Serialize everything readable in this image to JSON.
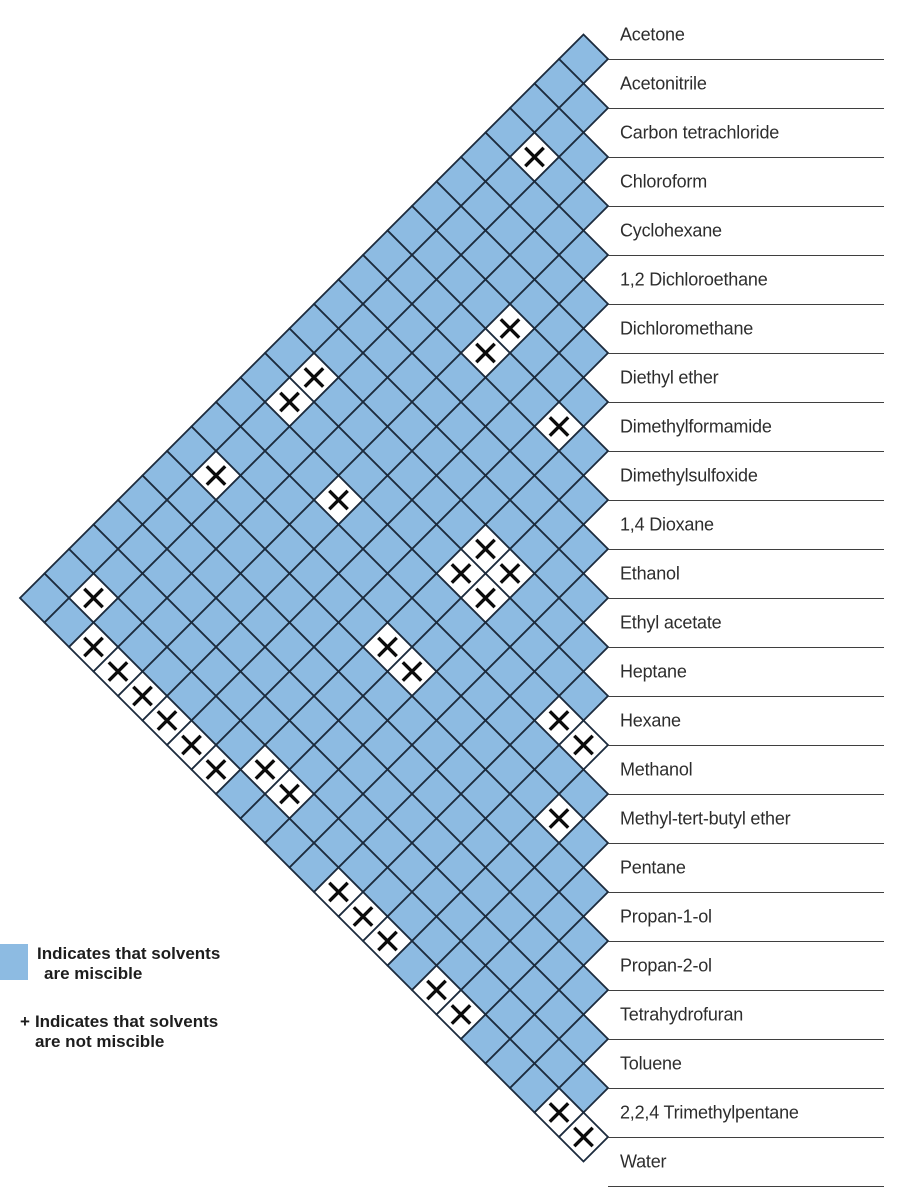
{
  "chart_data": {
    "type": "heatmap",
    "layout": "rotated-half-matrix-diamond",
    "categories": [
      "Acetone",
      "Acetonitrile",
      "Carbon tetrachloride",
      "Chloroform",
      "Cyclohexane",
      "1,2 Dichloroethane",
      "Dichloromethane",
      "Diethyl ether",
      "Dimethylformamide",
      "Dimethylsulfoxide",
      "1,4 Dioxane",
      "Ethanol",
      "Ethyl acetate",
      "Heptane",
      "Hexane",
      "Methanol",
      "Methyl-tert-butyl ether",
      "Pentane",
      "Propan-1-ol",
      "Propan-2-ol",
      "Tetrahydrofuran",
      "Toluene",
      "2,2,4 Trimethylpentane",
      "Water"
    ],
    "immiscible_pairs": [
      [
        "Acetonitrile",
        "Cyclohexane"
      ],
      [
        "Acetonitrile",
        "Heptane"
      ],
      [
        "Acetonitrile",
        "Hexane"
      ],
      [
        "Acetonitrile",
        "Pentane"
      ],
      [
        "Acetonitrile",
        "2,2,4 Trimethylpentane"
      ],
      [
        "Carbon tetrachloride",
        "Water"
      ],
      [
        "Chloroform",
        "Water"
      ],
      [
        "Cyclohexane",
        "Dimethylformamide"
      ],
      [
        "Cyclohexane",
        "Dimethylsulfoxide"
      ],
      [
        "Cyclohexane",
        "Methanol"
      ],
      [
        "Cyclohexane",
        "Water"
      ],
      [
        "1,2 Dichloroethane",
        "Water"
      ],
      [
        "Dichloromethane",
        "Water"
      ],
      [
        "Diethyl ether",
        "Dimethylsulfoxide"
      ],
      [
        "Diethyl ether",
        "Water"
      ],
      [
        "Dimethylformamide",
        "Heptane"
      ],
      [
        "Dimethylformamide",
        "Hexane"
      ],
      [
        "Dimethylformamide",
        "Pentane"
      ],
      [
        "Dimethylformamide",
        "2,2,4 Trimethylpentane"
      ],
      [
        "Dimethylsulfoxide",
        "Heptane"
      ],
      [
        "Dimethylsulfoxide",
        "Hexane"
      ],
      [
        "Dimethylsulfoxide",
        "Pentane"
      ],
      [
        "Dimethylsulfoxide",
        "2,2,4 Trimethylpentane"
      ],
      [
        "Ethyl acetate",
        "Water"
      ],
      [
        "Heptane",
        "Methanol"
      ],
      [
        "Heptane",
        "Water"
      ],
      [
        "Hexane",
        "Methanol"
      ],
      [
        "Hexane",
        "Water"
      ],
      [
        "Methanol",
        "Pentane"
      ],
      [
        "Methyl-tert-butyl ether",
        "Water"
      ],
      [
        "Pentane",
        "Water"
      ],
      [
        "Toluene",
        "Water"
      ],
      [
        "2,2,4 Trimethylpentane",
        "Water"
      ]
    ]
  },
  "legend": {
    "miscible_line1": "Indicates that solvents",
    "miscible_line2": "are miscible",
    "not_miscible_symbol": "+",
    "not_miscible_line1": "Indicates that solvents",
    "not_miscible_line2": "are not miscible"
  },
  "colors": {
    "miscible_fill": "#8DBBE2",
    "immiscible_fill": "#FFFFFF",
    "grid_line": "#1C2B3D",
    "cross_mark": "#0B0B0B",
    "label_text": "#2D2D2D",
    "separator_line": "#3F3F3F"
  }
}
